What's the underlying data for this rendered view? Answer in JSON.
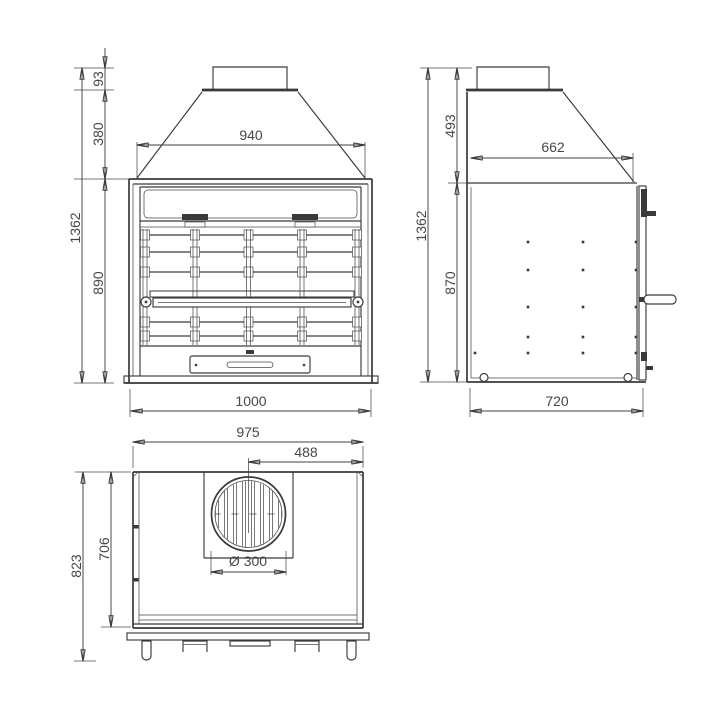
{
  "drawing": {
    "background": "#ffffff",
    "line_color": "#3a3a3a",
    "views": {
      "front": {
        "dims": {
          "duct_height": "93",
          "hood_height": "380",
          "overall_height": "1362",
          "firebox_height": "890",
          "opening_width": "940",
          "overall_width": "1000"
        }
      },
      "side": {
        "dims": {
          "hood_height": "493",
          "overall_height": "1362",
          "body_height": "870",
          "hood_top_depth": "662",
          "overall_depth": "720"
        }
      },
      "plan": {
        "dims": {
          "overall_width": "975",
          "flue_center_offset": "488",
          "overall_depth": "823",
          "body_depth": "706",
          "flue_diameter": "Ø 300"
        }
      }
    }
  }
}
